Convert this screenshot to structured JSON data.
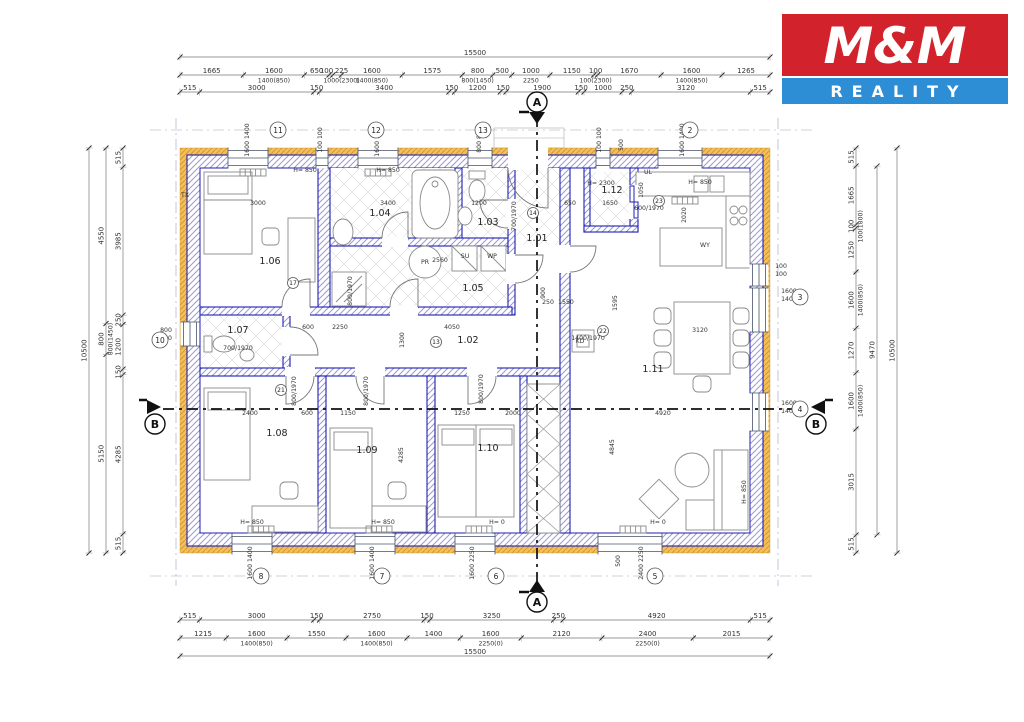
{
  "logo": {
    "line1": "M&M",
    "line2": "REALITY",
    "red": "#d2222b",
    "blue": "#2e8ed5"
  },
  "rooms": [
    [
      "1.01",
      537,
      241
    ],
    [
      "1.02",
      468,
      343
    ],
    [
      "1.03",
      488,
      225
    ],
    [
      "1.04",
      380,
      216
    ],
    [
      "1.05",
      473,
      291
    ],
    [
      "1.06",
      270,
      264
    ],
    [
      "1.07",
      238,
      333
    ],
    [
      "1.08",
      277,
      436
    ],
    [
      "1.09",
      367,
      453
    ],
    [
      "1.10",
      488,
      451
    ],
    [
      "1.11",
      653,
      372
    ],
    [
      "1.12",
      612,
      193
    ]
  ],
  "dimensions": [
    {
      "dir": "h",
      "pos": 57,
      "ticks": [
        180,
        770
      ],
      "labels": [
        [
          "15500",
          475
        ]
      ]
    },
    {
      "dir": "h",
      "pos": 75,
      "ticks": [
        180,
        243.4,
        304.3,
        329,
        332.8,
        341.4,
        402.3,
        462.3,
        492.8,
        511.8,
        549.9,
        593.7,
        597.5,
        661.1,
        722,
        770
      ],
      "labels": [
        [
          "1665",
          211.7
        ],
        [
          "1600",
          273.9,
          "1400(850)"
        ],
        [
          "650",
          316.7
        ],
        [
          "100",
          326.5
        ],
        [
          "225",
          341.5,
          "1000(2300)"
        ],
        [
          "1600",
          371.9,
          "1400(850)"
        ],
        [
          "1575",
          432.3
        ],
        [
          "800",
          477.6,
          "800(1450)"
        ],
        [
          "500",
          502.3
        ],
        [
          "1000",
          530.9,
          "2250"
        ],
        [
          "1150",
          571.8
        ],
        [
          "100",
          595.6,
          "100(2300)"
        ],
        [
          "1670",
          629.3
        ],
        [
          "1600",
          691.6,
          "1400(850)"
        ],
        [
          "1265",
          746.1
        ]
      ]
    },
    {
      "dir": "h",
      "pos": 92,
      "ticks": [
        180,
        199.6,
        313.8,
        319.5,
        448.9,
        454.6,
        500.3,
        506,
        578.3,
        584,
        622.1,
        631.6,
        750.4,
        770
      ],
      "labels": [
        [
          "515",
          189.8
        ],
        [
          "3000",
          256.7
        ],
        [
          "150",
          316.6
        ],
        [
          "3400",
          384.2
        ],
        [
          "150",
          451.7
        ],
        [
          "1200",
          477.5
        ],
        [
          "150",
          503.1
        ],
        [
          "1900",
          542.2
        ],
        [
          "150",
          581.1
        ],
        [
          "1000",
          603
        ],
        [
          "250",
          626.8
        ],
        [
          "3120",
          686
        ],
        [
          "515",
          760.2
        ]
      ]
    },
    {
      "dir": "h",
      "pos": 620,
      "ticks": [
        180,
        199.6,
        313.8,
        319.5,
        424.2,
        429.9,
        553.6,
        563.1,
        750.4,
        770
      ],
      "labels": [
        [
          "515",
          189.8
        ],
        [
          "3000",
          256.7
        ],
        [
          "150",
          316.6
        ],
        [
          "2750",
          372
        ],
        [
          "150",
          427
        ],
        [
          "3250",
          491.7
        ],
        [
          "250",
          558.3
        ],
        [
          "4920",
          656.7
        ],
        [
          "515",
          760.2
        ]
      ]
    },
    {
      "dir": "h",
      "pos": 638,
      "ticks": [
        180,
        226.2,
        287.1,
        346.1,
        407,
        460.3,
        521.2,
        601.9,
        693.3,
        770
      ],
      "labels": [
        [
          "1215",
          203.1
        ],
        [
          "1600",
          256.6,
          "1400(850)"
        ],
        [
          "1550",
          316.6
        ],
        [
          "1600",
          376.5,
          "1400(850)"
        ],
        [
          "1400",
          433.6
        ],
        [
          "1600",
          490.7,
          "2250(0)"
        ],
        [
          "2120",
          561.5
        ],
        [
          "2400",
          647.6,
          "2250(0)"
        ],
        [
          "2015",
          731.6
        ]
      ]
    },
    {
      "dir": "h",
      "pos": 656,
      "ticks": [
        180,
        770
      ],
      "labels": [
        [
          "15500",
          475
        ]
      ]
    },
    {
      "dir": "v",
      "pos": 123,
      "ticks": [
        148,
        167.1,
        315.2,
        324.5,
        369.1,
        374.7,
        533.9,
        553
      ],
      "labels": [
        [
          "515",
          157.6
        ],
        [
          "3985",
          241.2
        ],
        [
          "250",
          319.8
        ],
        [
          "1200",
          346.8
        ],
        [
          "150",
          371.9
        ],
        [
          "4285",
          454.3
        ],
        [
          "515",
          543.5
        ]
      ]
    },
    {
      "dir": "v",
      "pos": 106,
      "ticks": [
        148,
        323.5,
        354.4,
        553
      ],
      "labels": [
        [
          "4550",
          235.7
        ],
        [
          "800",
          339,
          "800(1450)"
        ],
        [
          "5150",
          453.7
        ]
      ]
    },
    {
      "dir": "v",
      "pos": 89,
      "ticks": [
        148,
        553
      ],
      "labels": [
        [
          "10500",
          350.5
        ]
      ]
    },
    {
      "dir": "v",
      "pos": 856,
      "ticks": [
        148,
        166.1,
        224.6,
        228.1,
        272,
        328.2,
        372.8,
        429,
        534.9,
        553
      ],
      "labels": [
        [
          "515",
          157
        ],
        [
          "1665",
          195.3
        ],
        [
          "100",
          226.3,
          "100(1800)"
        ],
        [
          "1250",
          250
        ],
        [
          "1600",
          300.1,
          "1400(850)"
        ],
        [
          "1270",
          350.5
        ],
        [
          "1600",
          400.9,
          "1400(850)"
        ],
        [
          "3015",
          482
        ],
        [
          "515",
          544
        ]
      ]
    },
    {
      "dir": "v",
      "pos": 877,
      "ticks": [
        166.1,
        534.9
      ],
      "labels": [
        [
          "9470",
          350
        ]
      ]
    },
    {
      "dir": "v",
      "pos": 897,
      "ticks": [
        148,
        553
      ],
      "labels": [
        [
          "10500",
          350.5
        ]
      ]
    }
  ],
  "bubbles": [
    [
      "11",
      278,
      130
    ],
    [
      "12",
      376,
      130
    ],
    [
      "13",
      483,
      130
    ],
    [
      "2",
      690,
      130
    ],
    [
      "8",
      261,
      576
    ],
    [
      "7",
      382,
      576
    ],
    [
      "6",
      496,
      576
    ],
    [
      "5",
      655,
      576
    ],
    [
      "10",
      160,
      340
    ],
    [
      "3",
      800,
      297
    ],
    [
      "4",
      800,
      409
    ],
    [
      "22",
      603,
      331,
      1
    ],
    [
      "23",
      659,
      201,
      1
    ],
    [
      "21",
      281,
      390,
      1
    ],
    [
      "17",
      293,
      283,
      1
    ],
    [
      "13",
      436,
      342,
      1
    ],
    [
      "14",
      533,
      213,
      1
    ]
  ],
  "annotations": [
    [
      "H= 850",
      305,
      172
    ],
    [
      "H= 850",
      388,
      172
    ],
    [
      "H= 850",
      700,
      184
    ],
    [
      "H= 2300",
      601,
      185
    ],
    [
      "H= 850",
      252,
      524
    ],
    [
      "H= 850",
      383,
      524
    ],
    [
      "H= 0",
      497,
      524
    ],
    [
      "H= 0",
      658,
      524
    ],
    [
      "H= 850",
      746,
      492,
      1
    ],
    [
      "3000",
      258,
      205
    ],
    [
      "3400",
      388,
      205
    ],
    [
      "1200",
      479,
      205
    ],
    [
      "650",
      570,
      205
    ],
    [
      "1650",
      610,
      205
    ],
    [
      "3120",
      700,
      332
    ],
    [
      "2020",
      686,
      215,
      1
    ],
    [
      "1050",
      643,
      190,
      1
    ],
    [
      "600",
      308,
      329
    ],
    [
      "2250",
      340,
      329
    ],
    [
      "4050",
      452,
      329
    ],
    [
      "2560",
      440,
      262
    ],
    [
      "1300",
      404,
      340,
      1
    ],
    [
      "900",
      545,
      293,
      1
    ],
    [
      "250",
      548,
      304
    ],
    [
      "1550",
      566,
      304
    ],
    [
      "1595",
      617,
      303,
      1
    ],
    [
      "2400",
      250,
      415
    ],
    [
      "600",
      307,
      415
    ],
    [
      "1150",
      348,
      415
    ],
    [
      "1250",
      462,
      415
    ],
    [
      "2000",
      513,
      415
    ],
    [
      "4920",
      663,
      415
    ],
    [
      "4285",
      403,
      455,
      1
    ],
    [
      "4845",
      614,
      447,
      1
    ],
    [
      "800/1970",
      296,
      391,
      1
    ],
    [
      "800/1970",
      368,
      391,
      1
    ],
    [
      "800/1970",
      483,
      389,
      1
    ],
    [
      "800/1970",
      352,
      291,
      1
    ],
    [
      "700/1970",
      516,
      216,
      1
    ],
    [
      "700/1970",
      238,
      350
    ],
    [
      "600/1970",
      649,
      210
    ],
    [
      "1400/1970",
      588,
      340
    ],
    [
      "1600 1400",
      249,
      140,
      1
    ],
    [
      "100 100",
      322,
      140,
      1
    ],
    [
      "1600 1400",
      379,
      140,
      1
    ],
    [
      "800 800",
      481,
      140,
      1
    ],
    [
      "100 100",
      601,
      140,
      1
    ],
    [
      "500",
      623,
      145,
      1
    ],
    [
      "1600 1400",
      684,
      140,
      1
    ],
    [
      "1600 1400",
      252,
      563,
      1
    ],
    [
      "1600 1400",
      374,
      563,
      1
    ],
    [
      "1600 2250",
      474,
      563,
      1
    ],
    [
      "500",
      620,
      561,
      1
    ],
    [
      "2400 2250",
      643,
      563,
      1
    ],
    [
      "800",
      166,
      332
    ],
    [
      "800",
      166,
      340
    ],
    [
      "100",
      781,
      268
    ],
    [
      "100",
      781,
      276
    ],
    [
      "1600",
      789,
      293
    ],
    [
      "1400",
      789,
      301
    ],
    [
      "1600",
      789,
      405
    ],
    [
      "1400",
      789,
      413
    ],
    [
      "SU",
      465,
      258
    ],
    [
      "WP",
      492,
      258
    ],
    [
      "PR",
      425,
      264
    ],
    [
      "KD",
      580,
      343
    ],
    [
      "UL",
      648,
      174
    ],
    [
      "WY",
      705,
      247
    ],
    [
      "TX",
      185,
      197
    ]
  ],
  "sections": [
    {
      "t": "A",
      "cx": 537,
      "cy": 102,
      "tri": "529,112 545,112 537,124",
      "bar": [
        519,
        112,
        529,
        112
      ]
    },
    {
      "t": "A",
      "cx": 537,
      "cy": 602,
      "tri": "529,592 545,592 537,580",
      "bar": [
        519,
        592,
        529,
        592
      ]
    },
    {
      "t": "B",
      "cx": 155,
      "cy": 424,
      "tri": "147,414 147,400 161,407",
      "bar": [
        139,
        400,
        147,
        400
      ]
    },
    {
      "t": "B",
      "cx": 816,
      "cy": 424,
      "tri": "825,414 825,400 811,407",
      "bar": [
        825,
        400,
        833,
        400
      ]
    }
  ]
}
